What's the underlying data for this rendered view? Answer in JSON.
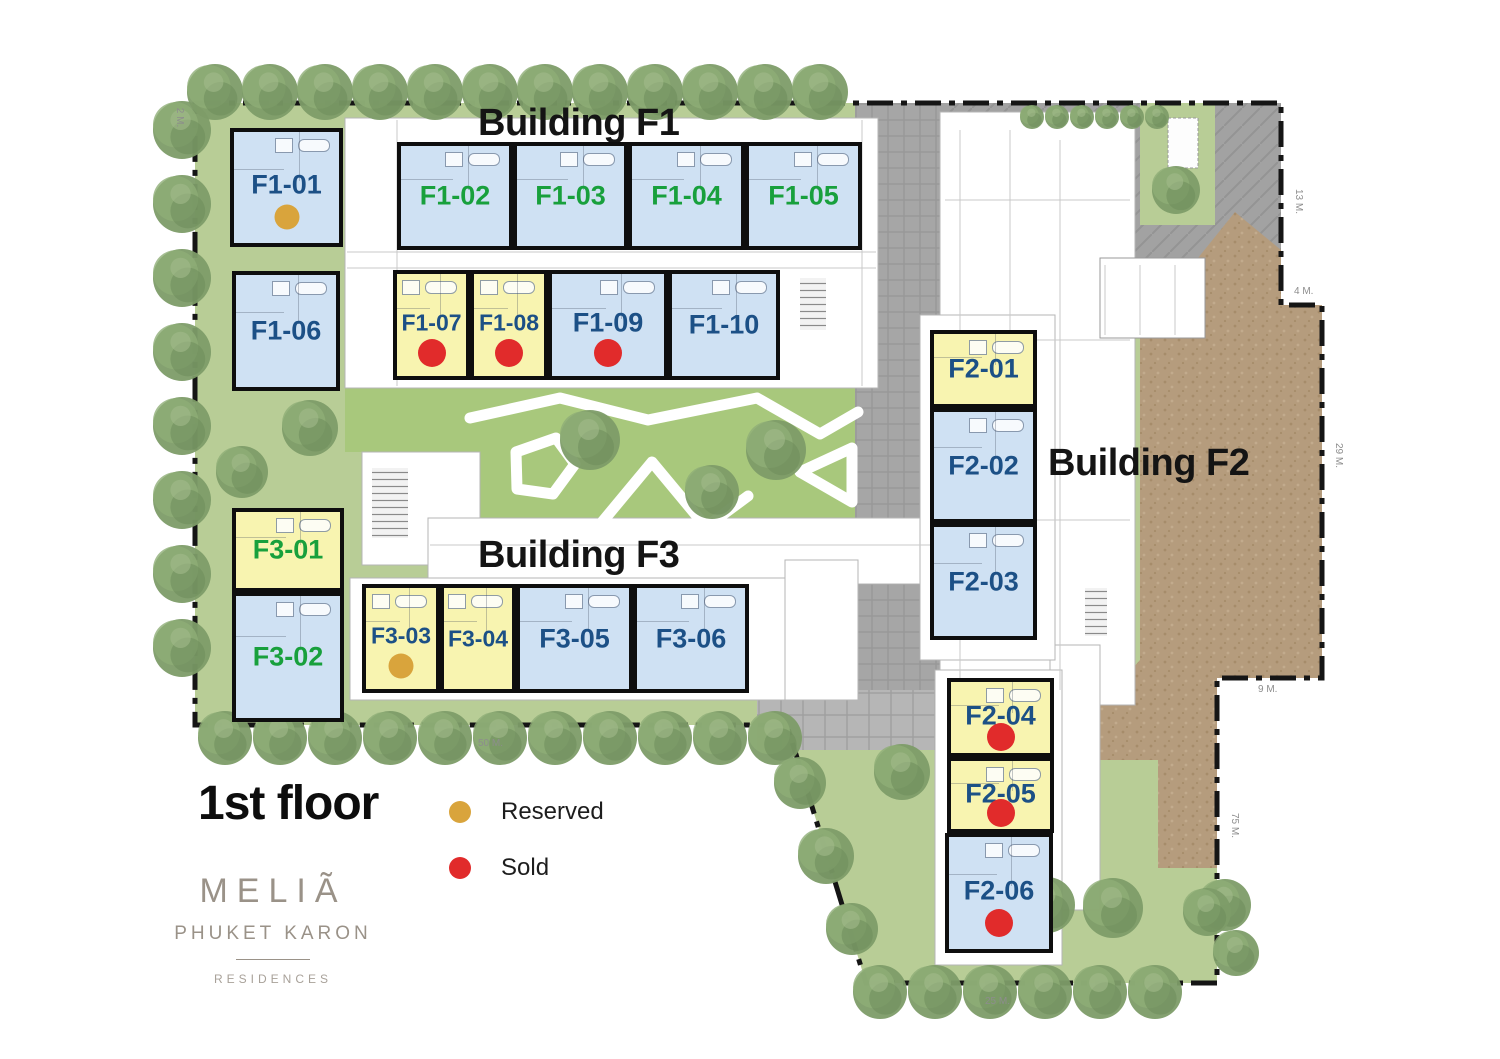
{
  "buildings": {
    "f1": {
      "title": "Building F1"
    },
    "f2": {
      "title": "Building F2"
    },
    "f3": {
      "title": "Building F3"
    }
  },
  "floor": {
    "label": "1st floor"
  },
  "legend": {
    "reserved_label": "Reserved",
    "sold_label": "Sold"
  },
  "logo": {
    "brand": "MELIÃ",
    "location": "PHUKET KARON",
    "division": "RESIDENCES"
  },
  "colors": {
    "unit_blue": "#cfe1f3",
    "unit_yellow": "#f8f4b0",
    "label_navy": "#1c5086",
    "label_green": "#18a03c",
    "reserved": "#d9a43c",
    "sold": "#e12b2b",
    "grass": "#b8cd96",
    "courtyard": "#a8c87c",
    "paving": "#a6a6a6",
    "dirt": "#b59c7d"
  },
  "units": [
    {
      "id": "F1-01",
      "label": "F1-01",
      "building": "F1",
      "fill": "blue",
      "label_color": "navy",
      "dot": "reserved",
      "status": "reserved"
    },
    {
      "id": "F1-02",
      "label": "F1-02",
      "building": "F1",
      "fill": "blue",
      "label_color": "green",
      "dot": null,
      "status": "available"
    },
    {
      "id": "F1-03",
      "label": "F1-03",
      "building": "F1",
      "fill": "blue",
      "label_color": "green",
      "dot": null,
      "status": "available"
    },
    {
      "id": "F1-04",
      "label": "F1-04",
      "building": "F1",
      "fill": "blue",
      "label_color": "green",
      "dot": null,
      "status": "available"
    },
    {
      "id": "F1-05",
      "label": "F1-05",
      "building": "F1",
      "fill": "blue",
      "label_color": "green",
      "dot": null,
      "status": "available"
    },
    {
      "id": "F1-06",
      "label": "F1-06",
      "building": "F1",
      "fill": "blue",
      "label_color": "navy",
      "dot": null,
      "status": "available"
    },
    {
      "id": "F1-07",
      "label": "F1-07",
      "building": "F1",
      "fill": "yellow",
      "label_color": "navy",
      "dot": "sold",
      "status": "sold"
    },
    {
      "id": "F1-08",
      "label": "F1-08",
      "building": "F1",
      "fill": "yellow",
      "label_color": "navy",
      "dot": "sold",
      "status": "sold"
    },
    {
      "id": "F1-09",
      "label": "F1-09",
      "building": "F1",
      "fill": "blue",
      "label_color": "navy",
      "dot": "sold",
      "status": "sold"
    },
    {
      "id": "F1-10",
      "label": "F1-10",
      "building": "F1",
      "fill": "blue",
      "label_color": "navy",
      "dot": null,
      "status": "available"
    },
    {
      "id": "F2-01",
      "label": "F2-01",
      "building": "F2",
      "fill": "yellow",
      "label_color": "navy",
      "dot": null,
      "status": "available"
    },
    {
      "id": "F2-02",
      "label": "F2-02",
      "building": "F2",
      "fill": "blue",
      "label_color": "navy",
      "dot": null,
      "status": "available"
    },
    {
      "id": "F2-03",
      "label": "F2-03",
      "building": "F2",
      "fill": "blue",
      "label_color": "navy",
      "dot": null,
      "status": "available"
    },
    {
      "id": "F2-04",
      "label": "F2-04",
      "building": "F2",
      "fill": "yellow",
      "label_color": "navy",
      "dot": "sold",
      "status": "sold"
    },
    {
      "id": "F2-05",
      "label": "F2-05",
      "building": "F2",
      "fill": "yellow",
      "label_color": "navy",
      "dot": "sold",
      "status": "sold"
    },
    {
      "id": "F2-06",
      "label": "F2-06",
      "building": "F2",
      "fill": "blue",
      "label_color": "navy",
      "dot": "sold",
      "status": "sold"
    },
    {
      "id": "F3-01",
      "label": "F3-01",
      "building": "F3",
      "fill": "yellow",
      "label_color": "green",
      "dot": null,
      "status": "available"
    },
    {
      "id": "F3-02",
      "label": "F3-02",
      "building": "F3",
      "fill": "blue",
      "label_color": "green",
      "dot": null,
      "status": "available"
    },
    {
      "id": "F3-03",
      "label": "F3-03",
      "building": "F3",
      "fill": "yellow",
      "label_color": "navy",
      "dot": "reserved",
      "status": "reserved"
    },
    {
      "id": "F3-04",
      "label": "F3-04",
      "building": "F3",
      "fill": "yellow",
      "label_color": "navy",
      "dot": null,
      "status": "available"
    },
    {
      "id": "F3-05",
      "label": "F3-05",
      "building": "F3",
      "fill": "blue",
      "label_color": "navy",
      "dot": null,
      "status": "available"
    },
    {
      "id": "F3-06",
      "label": "F3-06",
      "building": "F3",
      "fill": "blue",
      "label_color": "navy",
      "dot": null,
      "status": "available"
    }
  ],
  "dimensions": {
    "labels": [
      "13 M.",
      "4 M.",
      "29 M.",
      "9 M.",
      "75 M.",
      "25 M.",
      "50 M.",
      "2 M."
    ]
  }
}
